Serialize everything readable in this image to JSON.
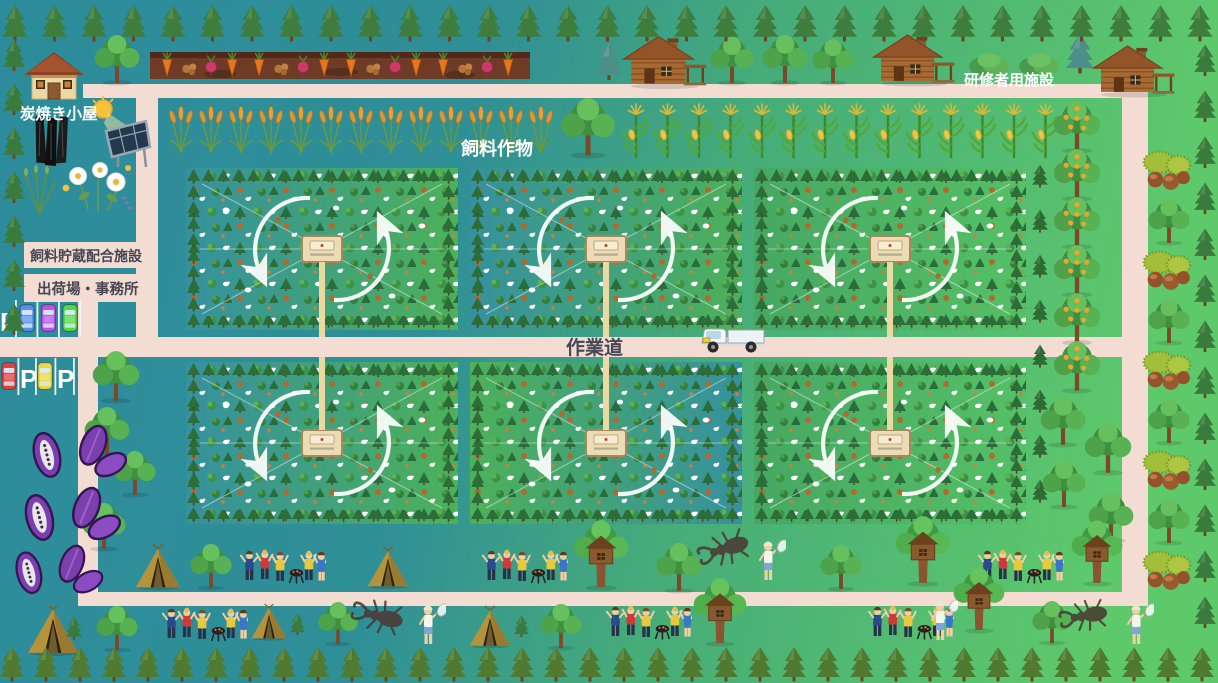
{
  "labels": {
    "charcoal_hut": "炭焼き小屋",
    "feed_storage_facility": "飼料貯蔵配合施設",
    "shipping_office": "出荷場・事務所",
    "feed_crops": "飼料作物",
    "work_road": "作業道",
    "trainee_facility": "研修者用施設"
  },
  "parking": {
    "letter": "P",
    "row1_cars": [
      "#5b8df0",
      "#c050e8",
      "#55d848"
    ],
    "row2_cars": [
      "#e04040",
      "#ecd93e"
    ]
  },
  "colors": {
    "bg_teal": "#2d8c9b",
    "bg_green": "#5ec96b",
    "road": "#f3dcd1",
    "paddock_path": "#ead9a0",
    "arrow": "#ffffff"
  },
  "paddocks": {
    "rows": 2,
    "cols": 3
  },
  "decor": {
    "top_pines": {
      "count": 31,
      "dx": 39.5
    },
    "bottom_pines": {
      "count": 36,
      "dx": 34
    },
    "left_pines": {
      "count": 7,
      "dy": 44
    },
    "right_pines": {
      "count": 13,
      "dy": 46
    },
    "wheat_row": {
      "count": 13,
      "dx": 30
    },
    "corn_row": {
      "count": 14,
      "dx": 31.5
    },
    "veg_sets": {
      "count": 4,
      "dx": 92
    },
    "fruit_trees": {
      "count": 6,
      "dy": 48
    },
    "paddock_side_pines": {
      "count": 8,
      "dy": 45
    },
    "right_chestnuts": {
      "count": 5,
      "dy": 100
    },
    "right_trees": {
      "count": 4,
      "dy": 100
    }
  }
}
